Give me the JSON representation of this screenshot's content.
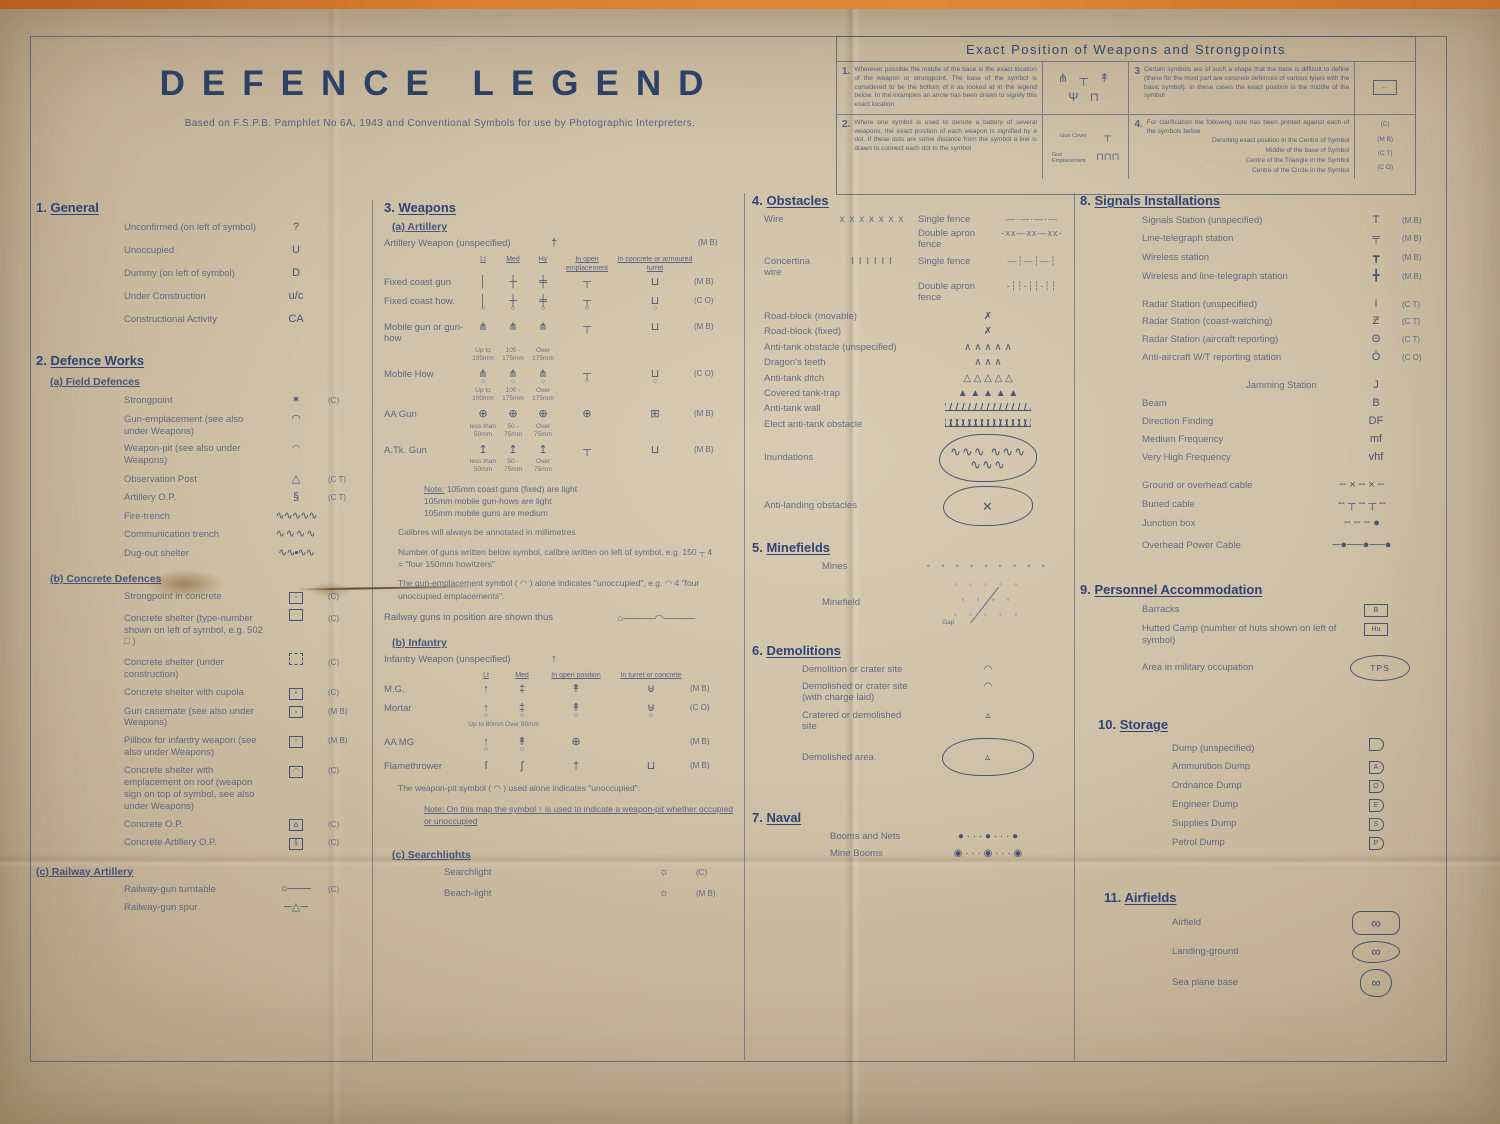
{
  "title": "DEFENCE LEGEND",
  "subtitle": "Based on F.S.P.B. Pamphlet No 6A, 1943 and Conventional Symbols for use by Photographic Interpreters.",
  "box": {
    "heading": "Exact Position of Weapons and Strongpoints",
    "i1": {
      "num": "1.",
      "text": "Wherever possible the middle of the base is the exact location of the weapon or strongpoint. The base of the symbol is considered to be the bottom of it as looked at in the legend below. In the examples an arrow has been drawn to signify this exact location",
      "syms": "⋔ ┬ ↟ Ψ ⊓"
    },
    "i2": {
      "num": "2.",
      "text": "Where one symbol is used to denote a battery of several weapons, the exact position of each weapon is signified by a dot. If these dots are some distance from the symbol a line is drawn to connect each dot to the symbol",
      "l1": "Gun Cover",
      "s1": "┬",
      "l2": "Gun Emplacement",
      "s2": "⊓⊓⊓"
    },
    "i3": {
      "num": "3",
      "text": "Certain symbols are of such a shape that the base is difficult to define (these for the most part are concrete defences of various types with the basic symbol). In these cases the exact position is the middle of the symbol",
      "sym": "←"
    },
    "i4": {
      "num": "4.",
      "intro": "For clarification the following note has been printed against each of the symbols below",
      "lines": [
        "Denoting exact position in the Centre of Symbol",
        "Middle of the base of Symbol",
        "Centre of the Triangle in the Symbol",
        "Centre of the Circle in the Symbol"
      ],
      "codes": [
        "(C)",
        "(M B)",
        "(C T)",
        "(C O)"
      ]
    }
  },
  "g": {
    "num": "1.",
    "title": "General",
    "rows": [
      {
        "l": "Unconfirmed (on left of symbol)",
        "s": "?",
        "c": ""
      },
      {
        "l": "Unoccupied",
        "s": "U",
        "c": ""
      },
      {
        "l": "Dummy (on left of symbol)",
        "s": "D",
        "c": ""
      },
      {
        "l": "Under Construction",
        "s": "u/c",
        "c": ""
      },
      {
        "l": "Constructional Activity",
        "s": "CA",
        "c": ""
      }
    ]
  },
  "dw": {
    "num": "2.",
    "title": "Defence Works",
    "a": {
      "t": "(a) Field Defences",
      "rows": [
        {
          "l": "Strongpoint",
          "s": "✶",
          "c": "(C)"
        },
        {
          "l": "Gun-emplacement (see also under Weapons)",
          "s": "◠",
          "c": ""
        },
        {
          "l": "Weapon-pit (see also under Weapons)",
          "s": "◠",
          "c": ""
        },
        {
          "l": "Observation Post",
          "s": "△",
          "c": "(C T)"
        },
        {
          "l": "Artillery O.P.",
          "s": "§",
          "c": "(C T)"
        },
        {
          "l": "Fire-trench",
          "s": "∿∿∿∿∿",
          "c": ""
        },
        {
          "l": "Communication trench",
          "s": "∿∿∿∿",
          "c": ""
        },
        {
          "l": "Dug-out shelter",
          "s": "∿∿▪∿∿",
          "c": ""
        }
      ]
    },
    "b": {
      "t": "(b) Concrete Defences",
      "rows": [
        {
          "l": "Strongpoint in concrete",
          "bx": "▫",
          "c": "(C)"
        },
        {
          "l": "Concrete shelter (type-number shown on left of symbol, e.g. 502 □ )",
          "bx": "",
          "c": "(C)"
        },
        {
          "l": "Concrete shelter (under construction)",
          "bx": "",
          "c": "(C)"
        },
        {
          "l": "Concrete shelter with cupola",
          "bx": "•",
          "c": "(C)"
        },
        {
          "l": "Gun casemate (see also under Weapons)",
          "bx": "›",
          "c": "(M B)"
        },
        {
          "l": "Pillbox for infantry weapon (see also under Weapons)",
          "bx": "↑",
          "c": "(M B)"
        },
        {
          "l": "Concrete shelter with emplacement on roof (weapon sign on top of symbol, see also under Weapons)",
          "bx": "◠",
          "c": "(C)"
        },
        {
          "l": "Concrete O.P.",
          "bx": "Δ",
          "c": "(C)"
        },
        {
          "l": "Concrete Artillery O.P.",
          "bx": "§",
          "c": "(C)"
        }
      ]
    },
    "c": {
      "t": "(c) Railway Artillery",
      "rows": [
        {
          "l": "Railway-gun turntable",
          "s": "○───",
          "c": "(C)"
        },
        {
          "l": "Railway-gun spur",
          "s": "─△─",
          "c": ""
        }
      ]
    }
  },
  "w": {
    "num": "3.",
    "title": "Weapons",
    "a": {
      "t": "(a) Artillery",
      "unspec": {
        "l": "Artillery Weapon (unspecified)",
        "s": "†",
        "c": "(M B)"
      },
      "h": [
        "Lt",
        "Med",
        "Hy",
        "In open emplacement",
        "In concrete or armoured turret"
      ],
      "rows": [
        {
          "l": "Fixed coast gun",
          "c": "(M B)",
          "cells": [
            {
              "t": "│"
            },
            {
              "t": "┼"
            },
            {
              "t": "╪"
            },
            {
              "t": "┬"
            },
            {
              "t": "⊔"
            }
          ]
        },
        {
          "l": "Fixed coast how.",
          "c": "(C O)",
          "cells": [
            {
              "t": "│",
              "b": "○"
            },
            {
              "t": "┼",
              "b": "○"
            },
            {
              "t": "╪",
              "b": "○"
            },
            {
              "t": "┬",
              "b": "○"
            },
            {
              "t": "⊔",
              "b": "○"
            }
          ]
        },
        {
          "l": "Mobile gun or gun-how",
          "c": "(M B)",
          "cells": [
            {
              "t": "⋔"
            },
            {
              "t": "⋔"
            },
            {
              "t": "⋔"
            },
            {
              "t": "┬"
            },
            {
              "t": "⊔"
            }
          ],
          "subs": [
            "Up to 105mm",
            "105 - 175mm",
            "Over 175mm"
          ]
        },
        {
          "l": "Mobile How",
          "c": "(C O)",
          "cells": [
            {
              "t": "⋔",
              "b": "○"
            },
            {
              "t": "⋔",
              "b": "○"
            },
            {
              "t": "⋔",
              "b": "○"
            },
            {
              "t": "┬",
              "b": "○"
            },
            {
              "t": "⊔",
              "b": "○"
            }
          ],
          "subs": [
            "Up to 100mm",
            "100 - 175mm",
            "Over 175mm"
          ]
        },
        {
          "l": "AA Gun",
          "c": "(M B)",
          "cells": [
            {
              "t": "⊕"
            },
            {
              "t": "⊕"
            },
            {
              "t": "⊕"
            },
            {
              "t": "⊕"
            },
            {
              "t": "⊞"
            }
          ],
          "subs": [
            "less than 50mm",
            "50 - 75mm",
            "Over 75mm"
          ]
        },
        {
          "l": "A.Tk. Gun",
          "c": "(M B)",
          "cells": [
            {
              "t": "↥"
            },
            {
              "t": "↥"
            },
            {
              "t": "↥"
            },
            {
              "t": "┬"
            },
            {
              "t": "⊔"
            }
          ],
          "subs": [
            "less than 50mm",
            "50 - 75mm",
            "Over 75mm"
          ]
        }
      ],
      "note_head": "Note:",
      "note_lines": [
        "105mm coast guns (fixed) are light",
        "105mm mobile gun-hows are light",
        "105mm mobile guns are medium"
      ],
      "p1": "Calibres will always be annotated in millimetres",
      "p2": "Number of guns written below symbol, calibre written on left of symbol, e.g. 150 ┬ 4  =  \"four 150mm howitzers\"",
      "p3": "The gun-emplacement symbol ( ◠ ) alone indicates \"unoccupied\", e.g. ◠ 4  \"four unoccupied emplacements\".",
      "rail": {
        "l": "Railway guns in position are shown thus",
        "s": "○────◠────"
      }
    },
    "b": {
      "t": "(b) Infantry",
      "unspec": {
        "l": "Infantry Weapon (unspecified)",
        "s": "↑"
      },
      "h": [
        "Lt",
        "Med",
        "In open position",
        "In turret or concrete"
      ],
      "rows": [
        {
          "l": "M.G.",
          "c": "(M B)",
          "cells": [
            {
              "t": "↑"
            },
            {
              "t": "‡"
            },
            {
              "t": "↟"
            },
            {
              "t": "⊎"
            }
          ]
        },
        {
          "l": "Mortar",
          "c": "(C O)",
          "cells": [
            {
              "t": "↑",
              "b": "○"
            },
            {
              "t": "‡",
              "b": "○"
            },
            {
              "t": "↟",
              "b": "○"
            },
            {
              "t": "⊎",
              "b": "○"
            }
          ],
          "subs": [
            "Up to 80mm",
            "Over 80mm"
          ]
        },
        {
          "l": "AA MG",
          "c": "(M B)",
          "cells": [
            {
              "t": "↑",
              "b": "○"
            },
            {
              "t": "↟",
              "b": "○"
            },
            {
              "t": "⊕"
            },
            {}
          ]
        },
        {
          "l": "Flamethrower",
          "c": "(M B)",
          "cells": [
            {
              "t": "ſ"
            },
            {
              "t": "ʃ"
            },
            {
              "t": "†"
            },
            {
              "t": "⊔"
            }
          ]
        }
      ],
      "p1": "The weapon-pit symbol ( ◠ ) used alone indicates \"unoccupied\".",
      "note": "Note: On this map the symbol ↑ is used to indicate a weapon-pit whether occupied or unoccupied"
    },
    "c": {
      "t": "(c) Searchlights",
      "rows": [
        {
          "l": "Searchlight",
          "s": "☼",
          "c": "(C)"
        },
        {
          "l": "Beach-light",
          "s": "☼",
          "c": "(M B)"
        }
      ]
    }
  },
  "ob": {
    "num": "4.",
    "title": "Obstacles",
    "wire": {
      "l": "Wire",
      "s": "x x x x x x x",
      "f1l": "Single fence",
      "f1s": "—·—·—·—",
      "f2l": "Double apron fence",
      "f2s": "-xx—xx—xx-"
    },
    "conc": {
      "l": "Concertina wire",
      "s": "Ι Ι Ι Ι Ι Ι",
      "f1l": "Single fence",
      "f1s": "—┆—┆—┆",
      "f2l": "Double apron fence",
      "f2s": "-┆┆-┆┆-┆┆"
    },
    "rows": [
      {
        "l": "Road-block (movable)",
        "s": "✗"
      },
      {
        "l": "Road-block (fixed)",
        "s": "✗"
      },
      {
        "l": "Anti-tank obstacle (unspecified)",
        "s": "∧ ∧ ∧ ∧ ∧"
      },
      {
        "l": "Dragon's teeth",
        "s": "∧ ∧ ∧"
      },
      {
        "l": "Anti-tank ditch",
        "s": "△ △ △ △ △"
      },
      {
        "l": "Covered tank-trap",
        "s": "▲ ▲ ▲ ▲ ▲"
      }
    ],
    "wall": {
      "l": "Anti-tank wall"
    },
    "elec": {
      "l": "Elect anti-tank obstacle"
    },
    "inun": {
      "l": "Inundations",
      "s": "∿∿∿ ∿∿∿ ∿∿∿"
    },
    "land": {
      "l": "Anti-landing obstacles",
      "s": "✕"
    }
  },
  "mf": {
    "num": "5.",
    "title": "Minefields",
    "mines": {
      "l": "Mines",
      "s": "◦ ◦ ◦ ◦ ◦ ◦ ◦ ◦ ◦"
    },
    "field": {
      "l": "Minefield",
      "r1": "◦ ◦ ◦ ◦ ◦",
      "r2": "◦ ◦ ◦ ◦",
      "r3": "◦ ◦ ◦ ◦ ◦",
      "gap": "Gap"
    }
  },
  "dm": {
    "num": "6.",
    "title": "Demolitions",
    "rows": [
      {
        "l": "Demolition or crater site",
        "s": "◠"
      },
      {
        "l": "Demolished or crater site (with charge laid)",
        "s": "◠"
      },
      {
        "l": "Cratered or demolished site",
        "s": "▵"
      },
      {
        "l": "Demolished area",
        "s": "▵"
      }
    ]
  },
  "nv": {
    "num": "7.",
    "title": "Naval",
    "rows": [
      {
        "l": "Booms and Nets",
        "s": "● · · · ● · · · ●"
      },
      {
        "l": "Mine Booms",
        "s": "◉ · · · ◉ · · · ◉"
      }
    ]
  },
  "sg": {
    "num": "8.",
    "title": "Signals Installations",
    "rows": [
      {
        "l": "Signals Station (unspecified)",
        "s": "T",
        "c": "(M B)"
      },
      {
        "l": "Line-telegraph station",
        "s": "╤",
        "c": "(M B)"
      },
      {
        "l": "Wireless station",
        "s": "┳",
        "c": "(M B)"
      },
      {
        "l": "Wireless and line-telegraph station",
        "s": "╋",
        "c": "(M B)"
      },
      {
        "l": "Radar Station (unspecified)",
        "s": "Ι",
        "c": "(C T)"
      },
      {
        "l": "Radar Station (coast-watching)",
        "s": "Ƶ",
        "c": "(C T)"
      },
      {
        "l": "Radar Station (aircraft reporting)",
        "s": "Θ",
        "c": "(C T)"
      },
      {
        "l": "Anti-aircraft W/T reporting station",
        "s": "Ō",
        "c": "(C O)"
      },
      {
        "l": "Jamming Station",
        "s": "J",
        "c": ""
      },
      {
        "l": "Beam",
        "s": "B",
        "c": ""
      },
      {
        "l": "Direction Finding",
        "s": "DF",
        "c": ""
      },
      {
        "l": "Medium Frequency",
        "s": "mf",
        "c": ""
      },
      {
        "l": "Very High Frequency",
        "s": "vhf",
        "c": ""
      },
      {
        "l": "Ground or overhead cable",
        "s": "╌ × ╌ × ╌",
        "c": ""
      },
      {
        "l": "Buried cable",
        "s": "╌ ┬ ╌ ┬ ╌",
        "c": ""
      },
      {
        "l": "Junction box",
        "s": "╌ ╌ ╌ ●",
        "c": ""
      },
      {
        "l": "Overhead Power Cable",
        "s": "─●──●──●",
        "c": ""
      }
    ]
  },
  "pa": {
    "num": "9.",
    "title": "Personnel Accommodation",
    "rows": [
      {
        "l": "Barracks",
        "bx": "B"
      },
      {
        "l": "Hutted Camp (number of huts shown on left of symbol)",
        "bx": "Hu"
      },
      {
        "l": "Area in military occupation",
        "oval": "TPS"
      }
    ]
  },
  "st": {
    "num": "10.",
    "title": "Storage",
    "rows": [
      {
        "l": "Dump (unspecified)",
        "d": ""
      },
      {
        "l": "Ammunition Dump",
        "d": "A"
      },
      {
        "l": "Ordnance Dump",
        "d": "O"
      },
      {
        "l": "Engineer Dump",
        "d": "E"
      },
      {
        "l": "Supplies Dump",
        "d": "S"
      },
      {
        "l": "Petrol Dump",
        "d": "P"
      }
    ]
  },
  "af": {
    "num": "11.",
    "title": "Airfields",
    "rows": [
      {
        "l": "Airfield",
        "s": "∞"
      },
      {
        "l": "Landing-ground",
        "s": "∞"
      },
      {
        "l": "Sea plane base",
        "s": "∞"
      }
    ]
  }
}
